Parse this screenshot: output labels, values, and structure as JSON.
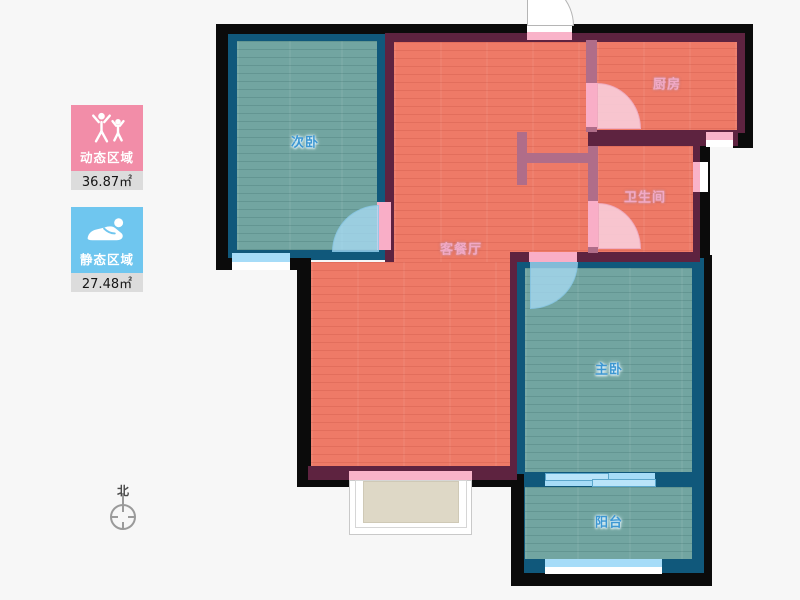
{
  "legend": {
    "dynamic": {
      "label": "动态区域",
      "area": "36.87㎡",
      "color": "#f28da8",
      "icon": "people-active-icon"
    },
    "static": {
      "label": "静态区域",
      "area": "27.48㎡",
      "color": "#6fc6ef",
      "icon": "person-resting-icon"
    }
  },
  "compass": {
    "label": "北"
  },
  "floorplan": {
    "rooms": [
      {
        "name": "secondary-bedroom",
        "label": "次卧",
        "zone": "static"
      },
      {
        "name": "kitchen",
        "label": "厨房",
        "zone": "dynamic"
      },
      {
        "name": "bathroom",
        "label": "卫生间",
        "zone": "dynamic"
      },
      {
        "name": "living-dining",
        "label": "客餐厅",
        "zone": "dynamic"
      },
      {
        "name": "master-bedroom",
        "label": "主卧",
        "zone": "static"
      },
      {
        "name": "balcony",
        "label": "阳台",
        "zone": "static"
      }
    ],
    "colors": {
      "dynamic_floor": "#ee7a67",
      "static_floor": "#72a5a1",
      "exterior_wall": "#5e2340",
      "partition_wall": "#b06d89",
      "bedroom_wall": "#10587b",
      "structural_wall": "#0b0b0b",
      "door_pink": "#f9aec7",
      "door_blue": "#a6dcf8",
      "window_white": "#ffffff"
    }
  }
}
